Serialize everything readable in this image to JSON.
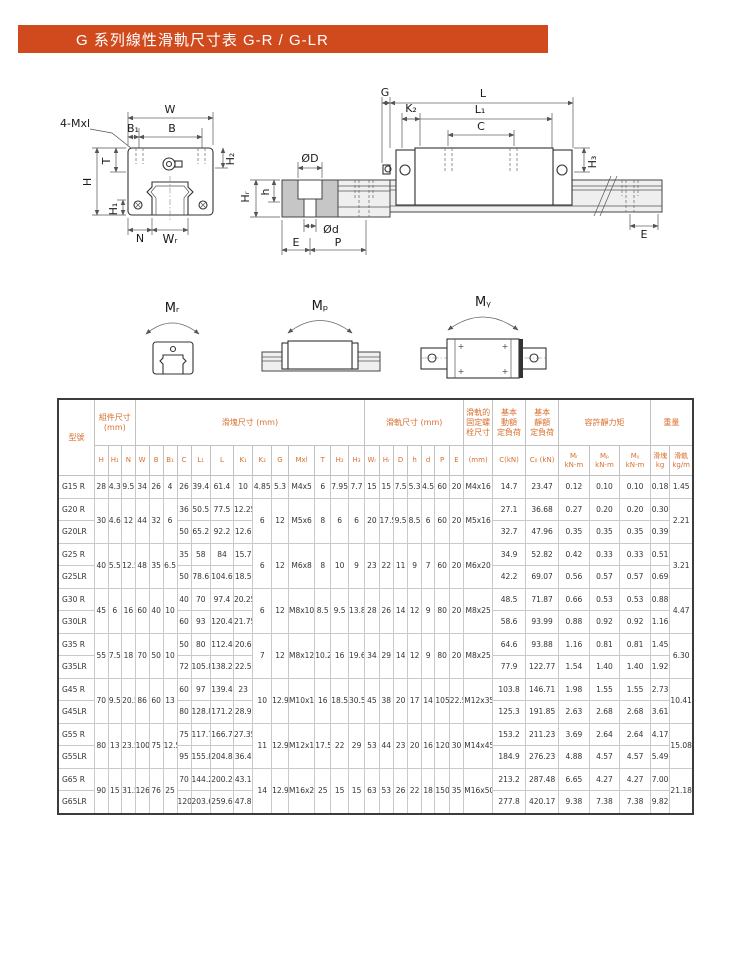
{
  "title": "G 系列線性滑軌尺寸表 G-R / G-LR",
  "colors": {
    "accent": "#d14a1d",
    "header_text": "#d9702e",
    "line": "#333333"
  },
  "diagram": {
    "front": {
      "w": "W",
      "b1": "B₁",
      "b": "B",
      "mxl": "4-Mxl",
      "t": "T",
      "h": "H",
      "h1": "H₁",
      "h2": "H₂",
      "n": "N",
      "wr": "Wᵣ"
    },
    "section": {
      "dd": "ØD",
      "dsm": "Ød",
      "e": "E",
      "p": "P",
      "hr": "Hᵣ",
      "h": "h"
    },
    "side": {
      "g": "G",
      "k2": "K₂",
      "l": "L",
      "l1": "L₁",
      "c": "C",
      "h3": "H₃",
      "e": "E"
    },
    "moment": {
      "mr": "Mᵣ",
      "mp": "Mₚ",
      "my": "Mᵧ"
    }
  },
  "table": {
    "header": {
      "model": "型號",
      "groups": [
        {
          "label": "組件尺寸\n(mm)"
        },
        {
          "label": "滑塊尺寸 (mm)"
        },
        {
          "label": "滑軌尺寸 (mm)"
        },
        {
          "label": "滑軌的\n固定螺\n栓尺寸"
        },
        {
          "label": "基本\n動額\n定負荷"
        },
        {
          "label": "基本\n靜額\n定負荷"
        },
        {
          "label": "容許靜力矩"
        },
        {
          "label": "重量"
        }
      ],
      "cols": [
        "H",
        "H₁",
        "N",
        "W",
        "B",
        "B₁",
        "C",
        "L₁",
        "L",
        "K₁",
        "K₂",
        "G",
        "Mxl",
        "T",
        "H₂",
        "H₃",
        "Wᵣ",
        "Hᵣ",
        "D",
        "h",
        "d",
        "P",
        "E",
        "(mm)",
        "C(kN)",
        "C₀ (kN)",
        "Mᵣ\nkN-m",
        "Mₚ\nkN-m",
        "Mᵧ\nkN-m",
        "滑塊\nkg",
        "滑軌\nkg/m"
      ]
    },
    "groups": [
      {
        "shared_left": [
          "28",
          "4.3",
          "9.5",
          "34",
          "26",
          "4"
        ],
        "rows": [
          {
            "model": "G15 R",
            "block": [
              "26",
              "39.4",
              "61.4",
              "10"
            ],
            "loads": [
              "14.7",
              "23.47",
              "0.12",
              "0.10",
              "0.10",
              "0.18"
            ]
          }
        ],
        "shared_mid": [
          "4.85",
          "5.3",
          "M4x5",
          "6",
          "7.95",
          "7.7",
          "15",
          "15",
          "7.5",
          "5.3",
          "4.5",
          "60",
          "20",
          "M4x16"
        ],
        "rail_weight": "1.45"
      },
      {
        "shared_left": [
          "30",
          "4.6",
          "12",
          "44",
          "32",
          "6"
        ],
        "rows": [
          {
            "model": "G20 R",
            "block": [
              "36",
              "50.5",
              "77.5",
              "12.25"
            ],
            "loads": [
              "27.1",
              "36.68",
              "0.27",
              "0.20",
              "0.20",
              "0.30"
            ]
          },
          {
            "model": "G20LR",
            "block": [
              "50",
              "65.2",
              "92.2",
              "12.6"
            ],
            "loads": [
              "32.7",
              "47.96",
              "0.35",
              "0.35",
              "0.35",
              "0.39"
            ]
          }
        ],
        "shared_mid": [
          "6",
          "12",
          "M5x6",
          "8",
          "6",
          "6",
          "20",
          "17.5",
          "9.5",
          "8.5",
          "6",
          "60",
          "20",
          "M5x16"
        ],
        "rail_weight": "2.21"
      },
      {
        "shared_left": [
          "40",
          "5.5",
          "12.5",
          "48",
          "35",
          "6.5"
        ],
        "rows": [
          {
            "model": "G25 R",
            "block": [
              "35",
              "58",
              "84",
              "15.7"
            ],
            "loads": [
              "34.9",
              "52.82",
              "0.42",
              "0.33",
              "0.33",
              "0.51"
            ]
          },
          {
            "model": "G25LR",
            "block": [
              "50",
              "78.6",
              "104.6",
              "18.5"
            ],
            "loads": [
              "42.2",
              "69.07",
              "0.56",
              "0.57",
              "0.57",
              "0.69"
            ]
          }
        ],
        "shared_mid": [
          "6",
          "12",
          "M6x8",
          "8",
          "10",
          "9",
          "23",
          "22",
          "11",
          "9",
          "7",
          "60",
          "20",
          "M6x20"
        ],
        "rail_weight": "3.21"
      },
      {
        "shared_left": [
          "45",
          "6",
          "16",
          "60",
          "40",
          "10"
        ],
        "rows": [
          {
            "model": "G30 R",
            "block": [
              "40",
              "70",
              "97.4",
              "20.25"
            ],
            "loads": [
              "48.5",
              "71.87",
              "0.66",
              "0.53",
              "0.53",
              "0.88"
            ]
          },
          {
            "model": "G30LR",
            "block": [
              "60",
              "93",
              "120.4",
              "21.75"
            ],
            "loads": [
              "58.6",
              "93.99",
              "0.88",
              "0.92",
              "0.92",
              "1.16"
            ]
          }
        ],
        "shared_mid": [
          "6",
          "12",
          "M8x10",
          "8.5",
          "9.5",
          "13.8",
          "28",
          "26",
          "14",
          "12",
          "9",
          "80",
          "20",
          "M8x25"
        ],
        "rail_weight": "4.47"
      },
      {
        "shared_left": [
          "55",
          "7.5",
          "18",
          "70",
          "50",
          "10"
        ],
        "rows": [
          {
            "model": "G35 R",
            "block": [
              "50",
              "80",
              "112.4",
              "20.6"
            ],
            "loads": [
              "64.6",
              "93.88",
              "1.16",
              "0.81",
              "0.81",
              "1.45"
            ]
          },
          {
            "model": "G35LR",
            "block": [
              "72",
              "105.8",
              "138.2",
              "22.5"
            ],
            "loads": [
              "77.9",
              "122.77",
              "1.54",
              "1.40",
              "1.40",
              "1.92"
            ]
          }
        ],
        "shared_mid": [
          "7",
          "12",
          "M8x12",
          "10.2",
          "16",
          "19.6",
          "34",
          "29",
          "14",
          "12",
          "9",
          "80",
          "20",
          "M8x25"
        ],
        "rail_weight": "6.30"
      },
      {
        "shared_left": [
          "70",
          "9.5",
          "20.5",
          "86",
          "60",
          "13"
        ],
        "rows": [
          {
            "model": "G45 R",
            "block": [
              "60",
              "97",
              "139.4",
              "23"
            ],
            "loads": [
              "103.8",
              "146.71",
              "1.98",
              "1.55",
              "1.55",
              "2.73"
            ]
          },
          {
            "model": "G45LR",
            "block": [
              "80",
              "128.8",
              "171.2",
              "28.9"
            ],
            "loads": [
              "125.3",
              "191.85",
              "2.63",
              "2.68",
              "2.68",
              "3.61"
            ]
          }
        ],
        "shared_mid": [
          "10",
          "12.9",
          "M10x17",
          "16",
          "18.5",
          "30.5",
          "45",
          "38",
          "20",
          "17",
          "14",
          "105",
          "22.5",
          "M12x35"
        ],
        "rail_weight": "10.41"
      },
      {
        "shared_left": [
          "80",
          "13",
          "23.5",
          "100",
          "75",
          "12.5"
        ],
        "rows": [
          {
            "model": "G55 R",
            "block": [
              "75",
              "117.7",
              "166.7",
              "27.35"
            ],
            "loads": [
              "153.2",
              "211.23",
              "3.69",
              "2.64",
              "2.64",
              "4.17"
            ]
          },
          {
            "model": "G55LR",
            "block": [
              "95",
              "155.8",
              "204.8",
              "36.4"
            ],
            "loads": [
              "184.9",
              "276.23",
              "4.88",
              "4.57",
              "4.57",
              "5.49"
            ]
          }
        ],
        "shared_mid": [
          "11",
          "12.9",
          "M12x18",
          "17.5",
          "22",
          "29",
          "53",
          "44",
          "23",
          "20",
          "16",
          "120",
          "30",
          "M14x45"
        ],
        "rail_weight": "15.08"
      },
      {
        "shared_left": [
          "90",
          "15",
          "31.5",
          "126",
          "76",
          "25"
        ],
        "rows": [
          {
            "model": "G65 R",
            "block": [
              "70",
              "144.2",
              "200.2",
              "43.1"
            ],
            "loads": [
              "213.2",
              "287.48",
              "6.65",
              "4.27",
              "4.27",
              "7.00"
            ]
          },
          {
            "model": "G65LR",
            "block": [
              "120",
              "203.6",
              "259.6",
              "47.8"
            ],
            "loads": [
              "277.8",
              "420.17",
              "9.38",
              "7.38",
              "7.38",
              "9.82"
            ]
          }
        ],
        "shared_mid": [
          "14",
          "12.9",
          "M16x20",
          "25",
          "15",
          "15",
          "63",
          "53",
          "26",
          "22",
          "18",
          "150",
          "35",
          "M16x50"
        ],
        "rail_weight": "21.18"
      }
    ]
  }
}
